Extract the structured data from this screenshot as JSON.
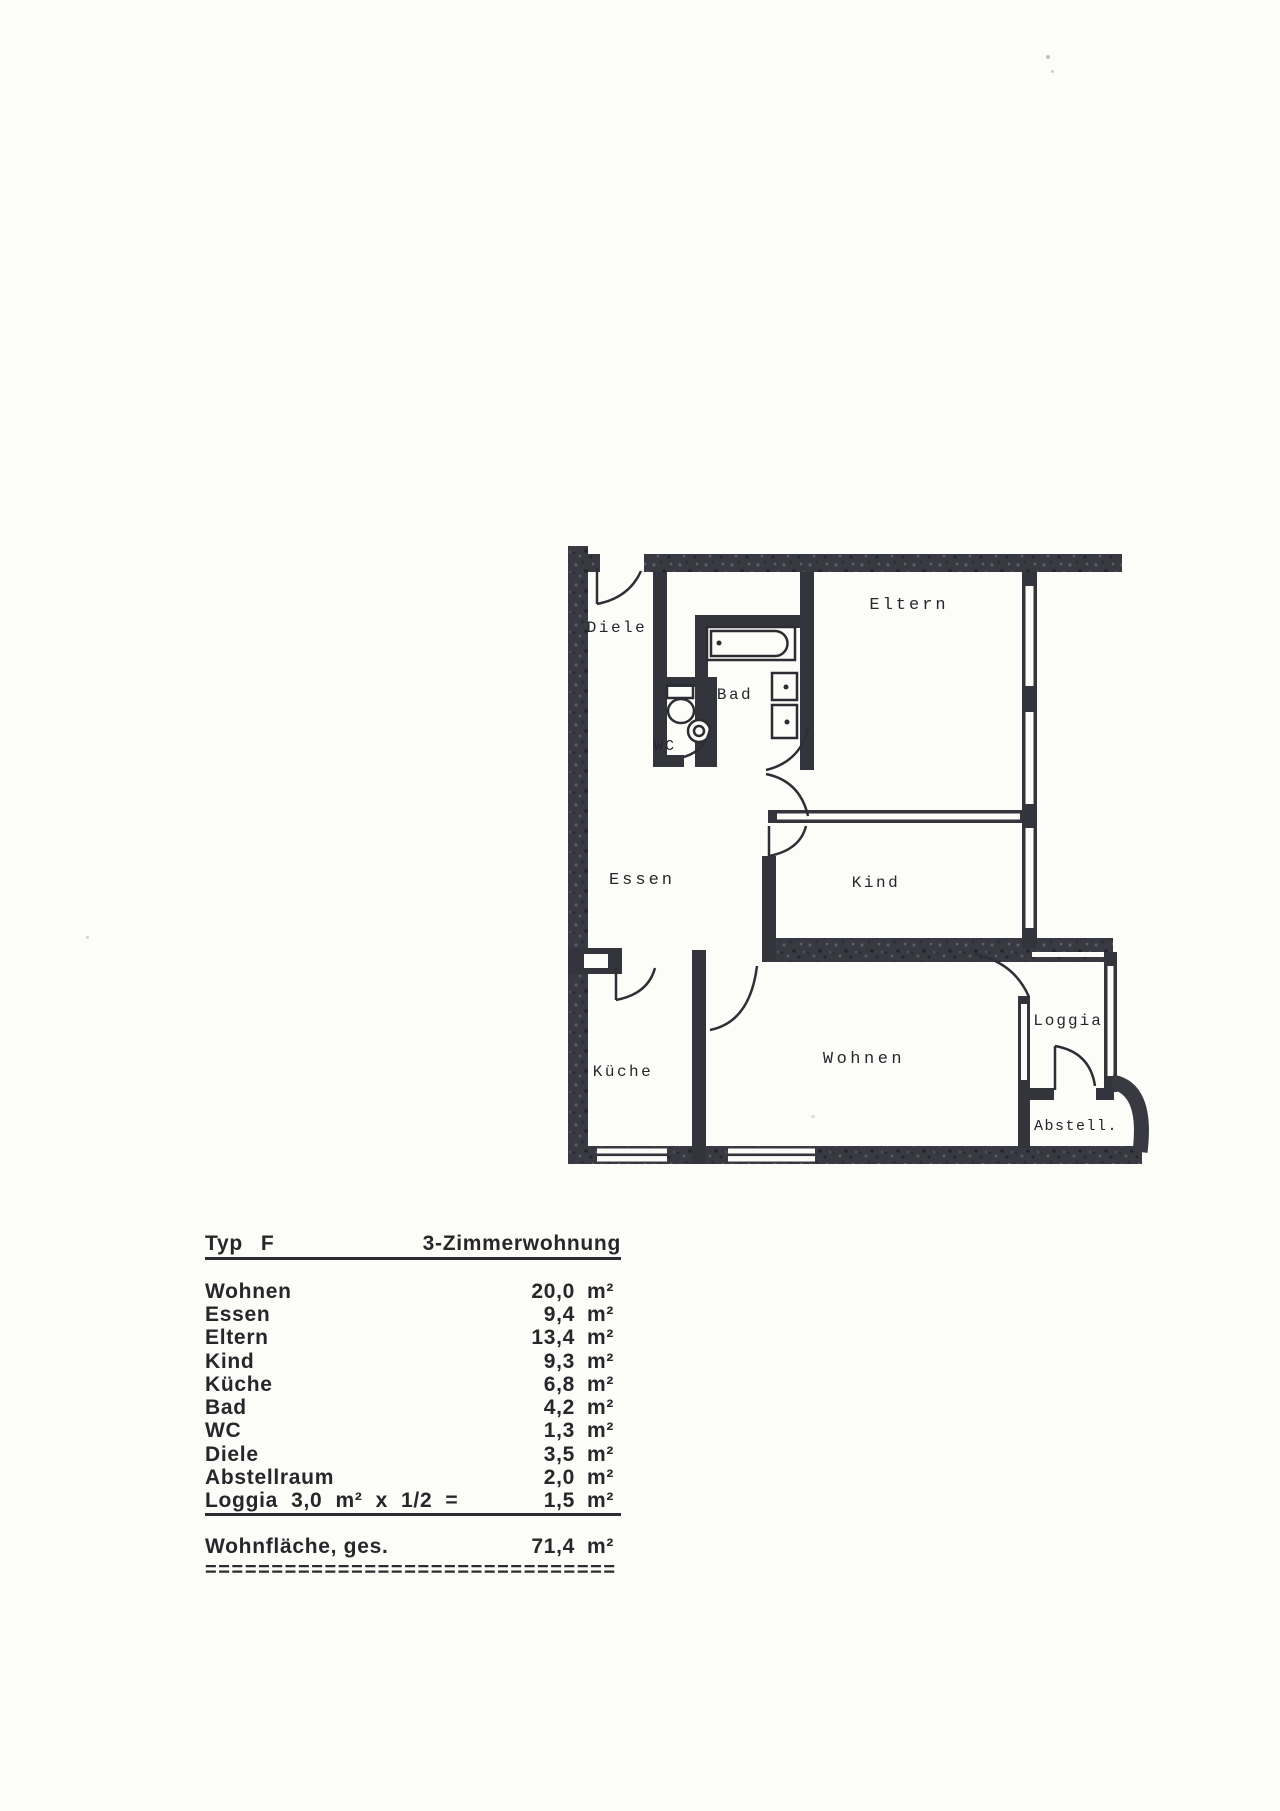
{
  "colors": {
    "paper": "#fcfcf9",
    "ink": "#2a2b31",
    "wall": "#383941"
  },
  "floor_plan": {
    "rooms": {
      "diele": "Diele",
      "bad": "Bad",
      "wc": "WC",
      "eltern": "Eltern",
      "essen": "Essen",
      "kind": "Kind",
      "kueche": "Küche",
      "wohnen": "Wohnen",
      "loggia": "Loggia",
      "abstell": "Abstell."
    },
    "fixtures": [
      "bathtub-icon",
      "washbasin-icon",
      "washbasin-icon",
      "toilet-icon",
      "corner-sink-icon"
    ]
  },
  "table": {
    "header": {
      "type_label": "Typ",
      "type_value": "F",
      "apartment_type": "3-Zimmerwohnung"
    },
    "rows": [
      {
        "label": "Wohnen",
        "value": "20,0",
        "unit": "m²"
      },
      {
        "label": "Essen",
        "value": "9,4",
        "unit": "m²"
      },
      {
        "label": "Eltern",
        "value": "13,4",
        "unit": "m²"
      },
      {
        "label": "Kind",
        "value": "9,3",
        "unit": "m²"
      },
      {
        "label": "Küche",
        "value": "6,8",
        "unit": "m²"
      },
      {
        "label": "Bad",
        "value": "4,2",
        "unit": "m²"
      },
      {
        "label": "WC",
        "value": "1,3",
        "unit": "m²"
      },
      {
        "label": "Diele",
        "value": "3,5",
        "unit": "m²"
      },
      {
        "label": "Abstellraum",
        "value": "2,0",
        "unit": "m²"
      },
      {
        "label": "Loggia  3,0  m²  x  1/2  =",
        "value": "1,5",
        "unit": "m²"
      }
    ],
    "total": {
      "label": "Wohnfläche, ges.",
      "value": "71,4",
      "unit": "m²"
    },
    "separator": "==============================="
  }
}
